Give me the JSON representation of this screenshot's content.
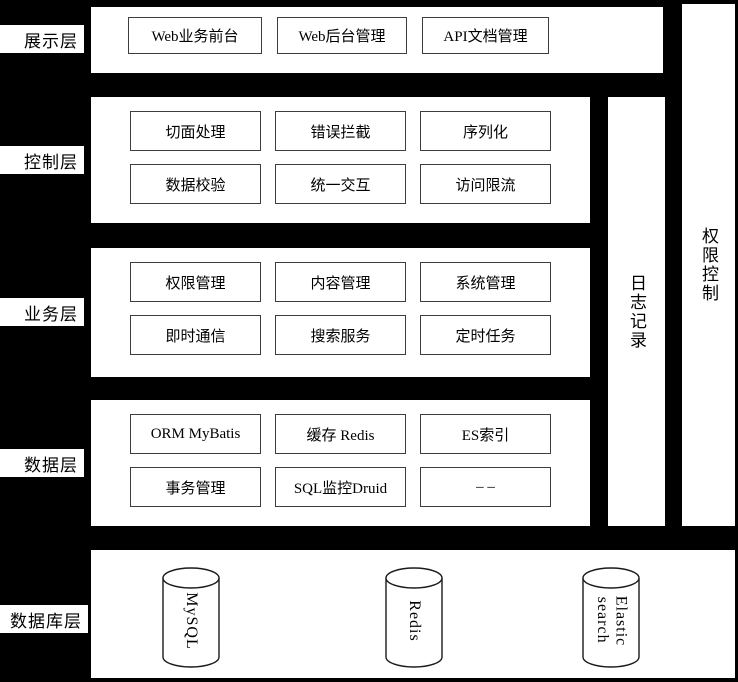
{
  "colors": {
    "background": "#000000",
    "panel_fill": "#ffffff",
    "box_border": "#3d3d3d",
    "text": "#000000"
  },
  "layers": {
    "presentation": {
      "label": "展示层",
      "boxes": [
        "Web业务前台",
        "Web后台管理",
        "API文档管理"
      ]
    },
    "control": {
      "label": "控制层",
      "boxes": [
        "切面处理",
        "错误拦截",
        "序列化",
        "数据校验",
        "统一交互",
        "访问限流"
      ]
    },
    "business": {
      "label": "业务层",
      "boxes": [
        "权限管理",
        "内容管理",
        "系统管理",
        "即时通信",
        "搜索服务",
        "定时任务"
      ]
    },
    "data": {
      "label": "数据层",
      "boxes": [
        "ORM MyBatis",
        "缓存 Redis",
        "ES索引",
        "事务管理",
        "SQL监控Druid",
        "– –"
      ]
    },
    "database": {
      "label": "数据库层",
      "cylinders": [
        "MySQL",
        "Redis",
        "Elastic search"
      ]
    }
  },
  "side_columns": {
    "log": "日志记录",
    "permission": "权限控制"
  }
}
